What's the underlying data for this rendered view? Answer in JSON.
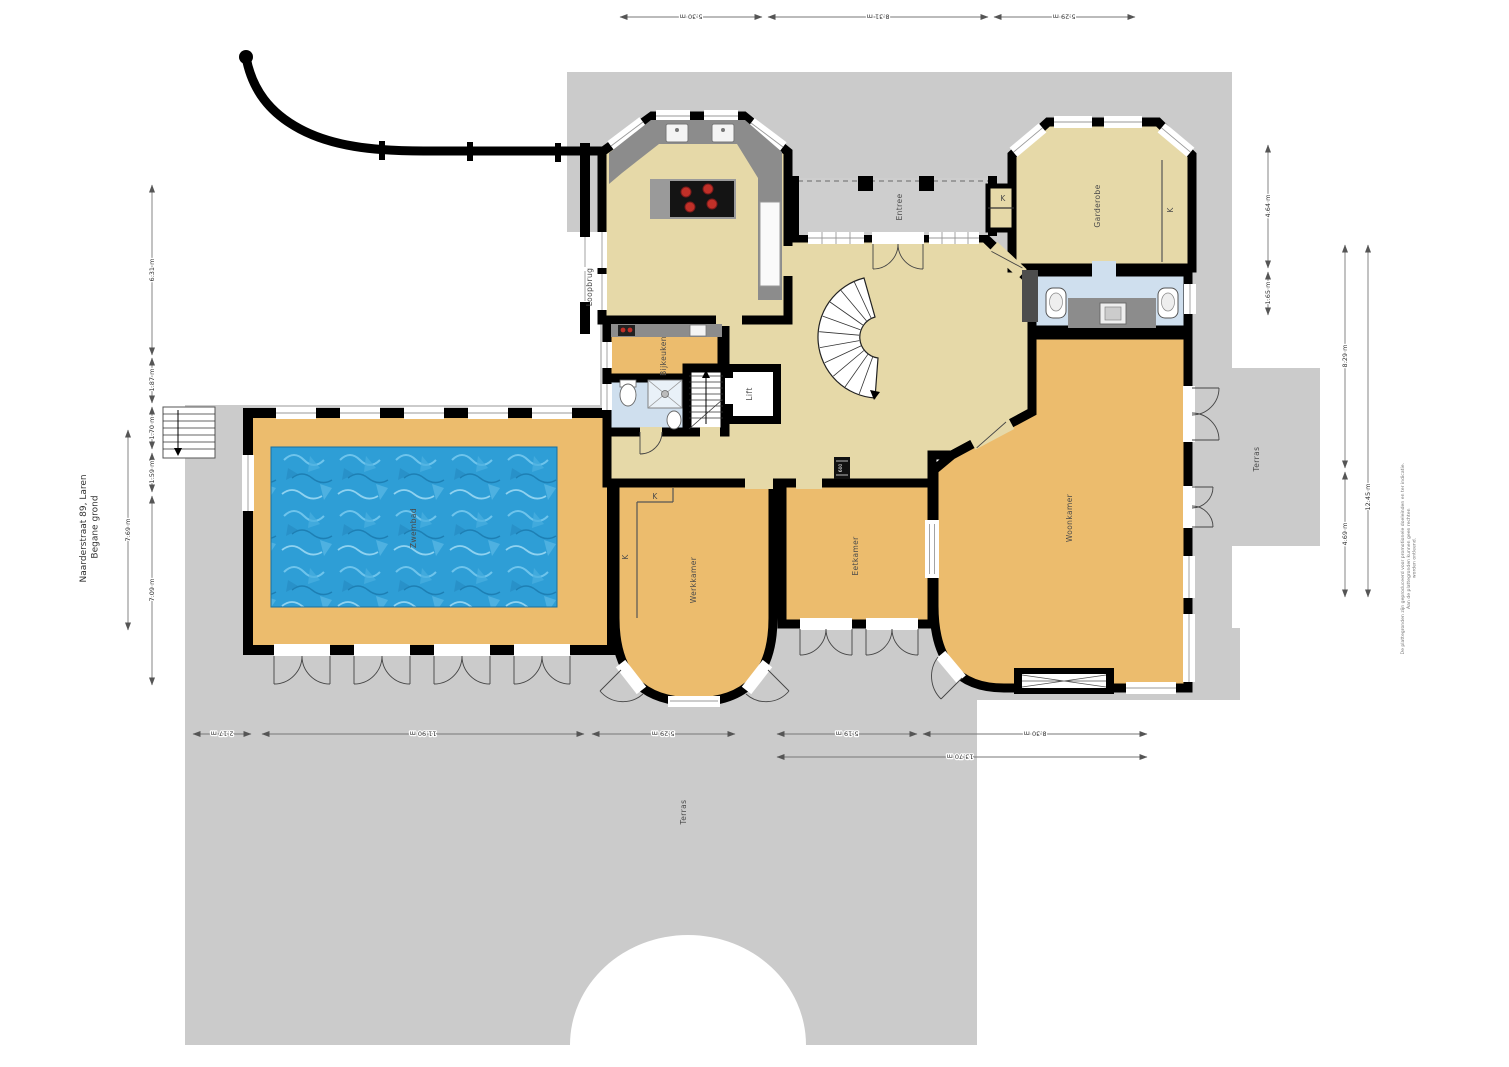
{
  "title": {
    "address": "Naarderstraat 89, Laren",
    "floor": "Begane grond"
  },
  "rooms": {
    "loopbrug": "Loopbrug",
    "bijkeuken": "Bijkeuken",
    "lift": "Lift",
    "entree": "Entree",
    "garderobe": "Garderobe",
    "werkkamer": "Werkkamer",
    "eetkamer": "Eetkamer",
    "woonkamer": "Woonkamer",
    "zwembad": "Zwembad",
    "terras_right": "Terras",
    "terras_bottom": "Terras",
    "closet": "K",
    "boiler": "600"
  },
  "dimensions": {
    "top": [
      "5.30 m",
      "8.31 m",
      "5.29 m"
    ],
    "left_outer": "7.69 m",
    "left_inner": [
      "6.31 m",
      "1.87 m",
      "1.70 m",
      "1.59 m",
      "7.09 m"
    ],
    "right_inner": [
      "4.64 m",
      "1.65 m"
    ],
    "right_mid": [
      "8.29 m",
      "4.69 m"
    ],
    "right_total": "12.45 m",
    "bottom": [
      "2.17 m",
      "11.90 m",
      "5.29 m",
      "5.19 m",
      "8.30 m"
    ],
    "bottom_total": "13.70 m"
  },
  "disclaimer": {
    "line1": "De plattegronden zijn geproduceerd voor promotionele doeleinden en ter indicatie.",
    "line2": "Aan de plattegronden kunnen geen rechten",
    "line3": "worden ontleend."
  },
  "colors": {
    "wall": "#000000",
    "terrace": "#cbcbcb",
    "floor_tan": "#e6d9a8",
    "floor_orange": "#ecbc6d",
    "bath_blue": "#cfdfee",
    "pool_blue": "#2e9ed6",
    "counter_gray": "#8c8c8c"
  }
}
